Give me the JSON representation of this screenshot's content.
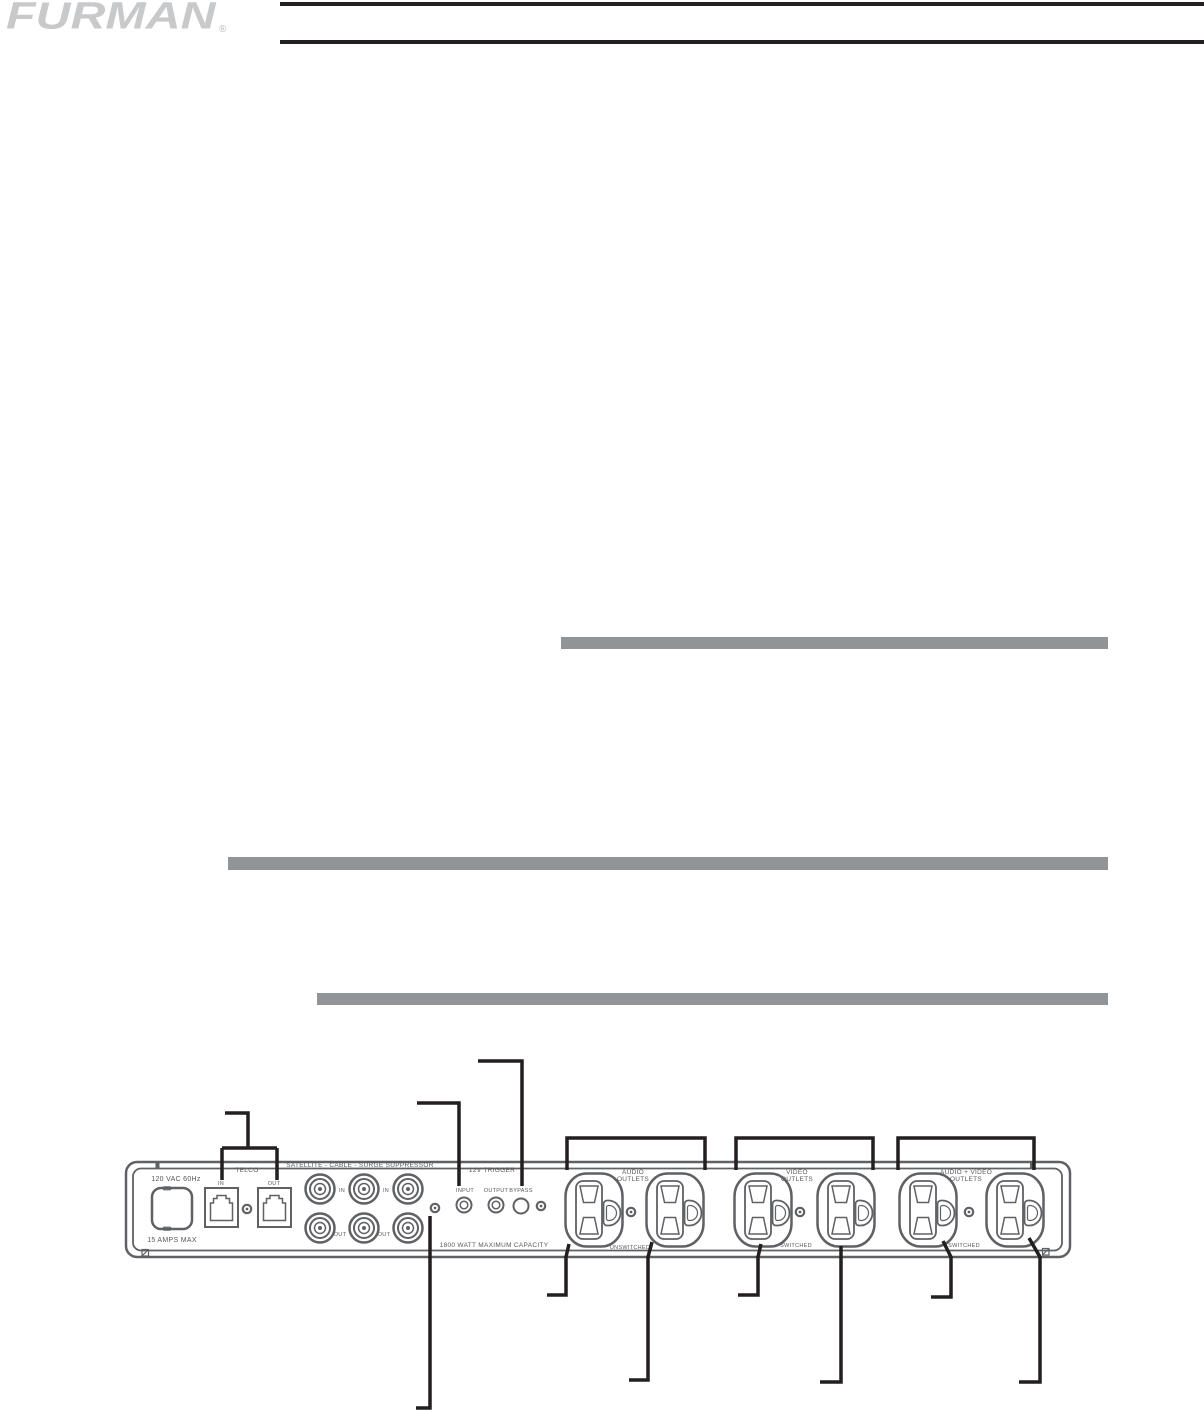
{
  "brand": {
    "logo_text": "FURMAN",
    "registered_mark": "®"
  },
  "rear_panel_diagram": {
    "power_inlet": {
      "rating_label": "120 VAC 60Hz",
      "max_current_label": "15 AMPS MAX"
    },
    "telco": {
      "title": "TELCO",
      "in_label": "IN",
      "out_label": "OUT"
    },
    "satellite_cable": {
      "title": "SATELLITE - CABLE - SURGE SUPPRESSOR",
      "in_label": "IN",
      "out_label": "OUT"
    },
    "trigger_12v": {
      "title": "12V TRIGGER",
      "input_label": "INPUT",
      "output_label": "OUTPUT",
      "bypass_label": "BYPASS"
    },
    "capacity_label": "1800 WATT MAXIMUM CAPACITY",
    "outlet_groups": [
      {
        "name_line1": "AUDIO",
        "name_line2": "OUTLETS",
        "switching_label": "UNSWITCHED"
      },
      {
        "name_line1": "VIDEO",
        "name_line2": "OUTLETS",
        "switching_label": "SWITCHED"
      },
      {
        "name_line1": "AUDIO + VIDEO",
        "name_line2": "OUTLETS",
        "switching_label": "SWITCHED"
      }
    ]
  },
  "colors": {
    "rule_black": "#231f20",
    "section_bar_gray": "#919497",
    "logo_gray": "#c8c9cb",
    "panel_stroke_gray": "#5f6164"
  }
}
